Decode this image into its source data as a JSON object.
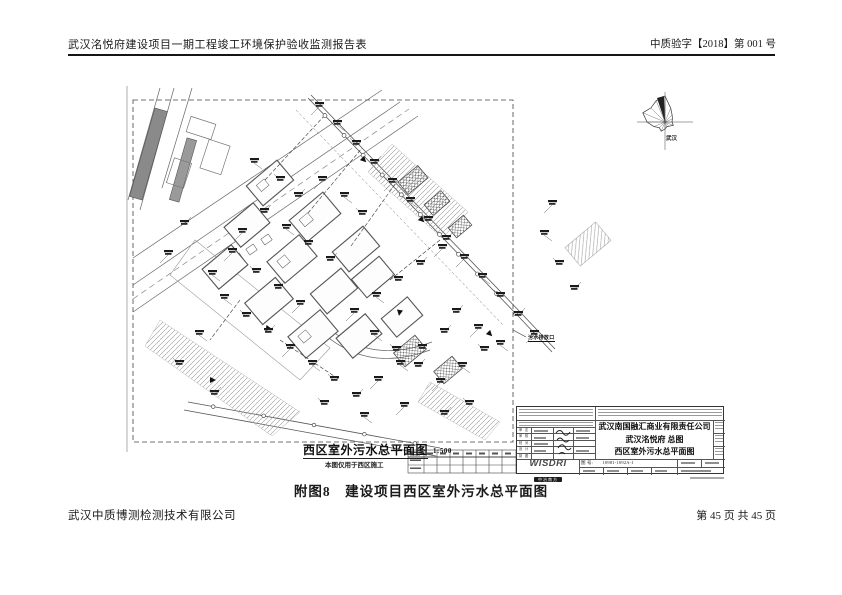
{
  "header": {
    "left": "武汉洺悦府建设项目一期工程竣工环境保护验收监测报告表",
    "right": "中质验字【2018】第 001 号"
  },
  "footer": {
    "company": "武汉中质博测检测技术有限公司",
    "page": "第 45 页 共 45 页"
  },
  "caption": "附图8　建设项目西区室外污水总平面图",
  "drawing": {
    "plan_title": "西区室外污水总平面图",
    "plan_scale": "1:500",
    "plan_subtitle": "本图仅用于西区施工",
    "outfall_label": "污水排放口",
    "windrose_label": "武汉",
    "titleblock": {
      "company": "武汉南国融汇商业有限责任公司",
      "project": "武汉洺悦府 总图",
      "drawing_name": "西区室外污水总平面图",
      "logo": "WISDRI",
      "logo_sub": "中冶南方",
      "drawing_no_label": "图 号:",
      "drawing_no": "10981-1092A-1",
      "rev_rows": [
        "审 定",
        "审 核",
        "校 对",
        "设 计",
        "制 图"
      ]
    }
  }
}
